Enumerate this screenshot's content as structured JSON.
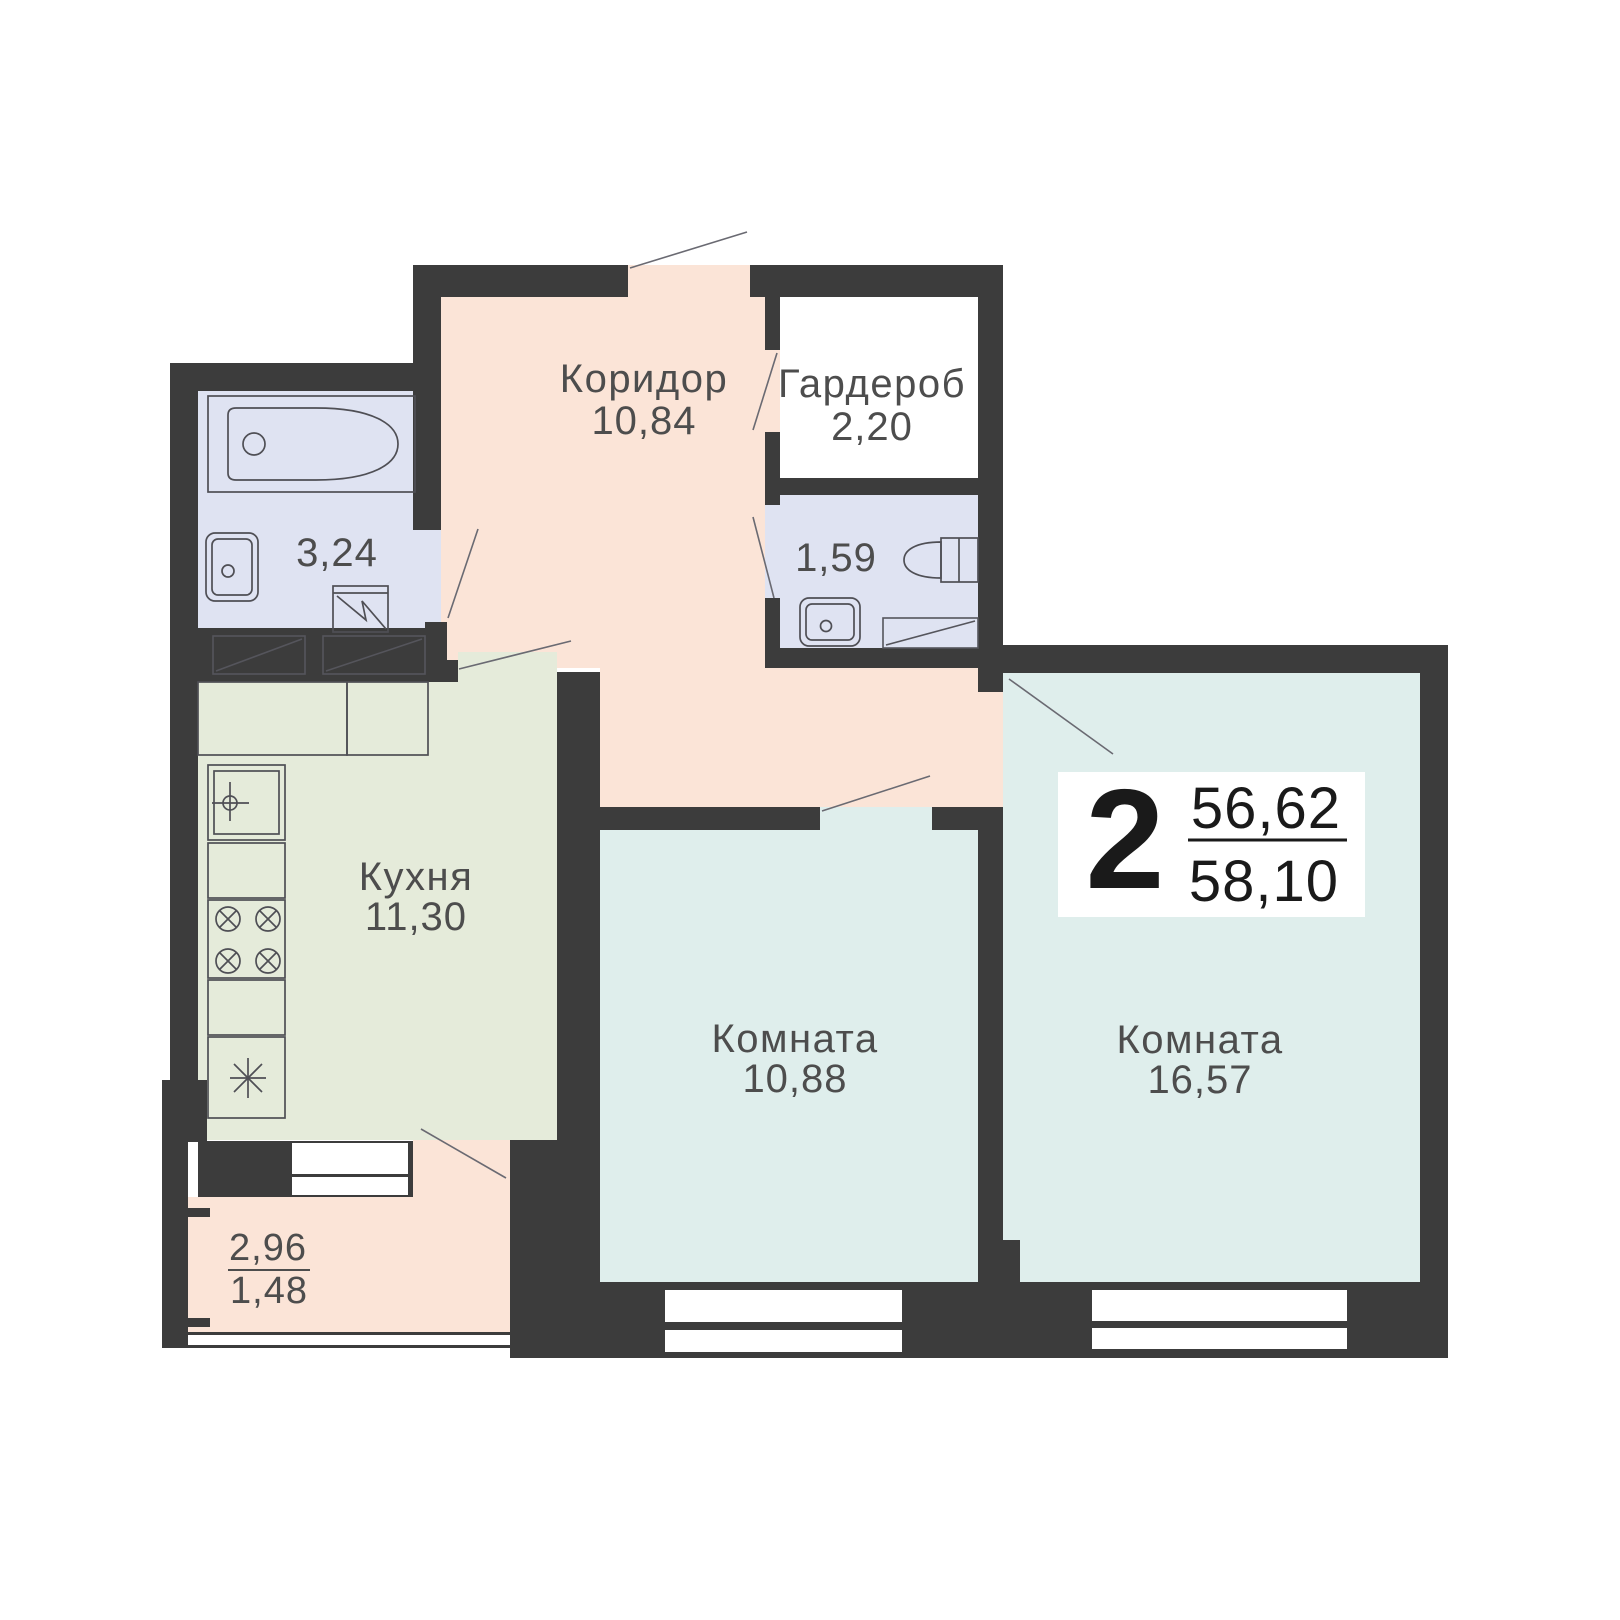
{
  "plan_type": "apartment-floor-plan",
  "badge": {
    "rooms_count": "2",
    "living_area": "56,62",
    "total_area": "58,10"
  },
  "rooms": {
    "corridor": {
      "label": "Коридор",
      "area": "10,84"
    },
    "wardrobe": {
      "label": "Гардероб",
      "area": "2,20"
    },
    "bathroom": {
      "area": "3,24"
    },
    "wc": {
      "area": "1,59"
    },
    "kitchen": {
      "label": "Кухня",
      "area": "11,30"
    },
    "room_small": {
      "label": "Комната",
      "area": "10,88"
    },
    "room_large": {
      "label": "Комната",
      "area": "16,57"
    },
    "balcony": {
      "area_full": "2,96",
      "area_reduced": "1,48"
    }
  },
  "colors": {
    "wall": "#3c3c3c",
    "hall": "#fbe4d7",
    "wet": "#dfe3f2",
    "kitchen": "#e5ebda",
    "living": "#dfeeec",
    "window": "#ffffff",
    "text": "#4d4d4d",
    "badge_ink": "#1a1a1a",
    "badge_bg": "#ffffff"
  }
}
